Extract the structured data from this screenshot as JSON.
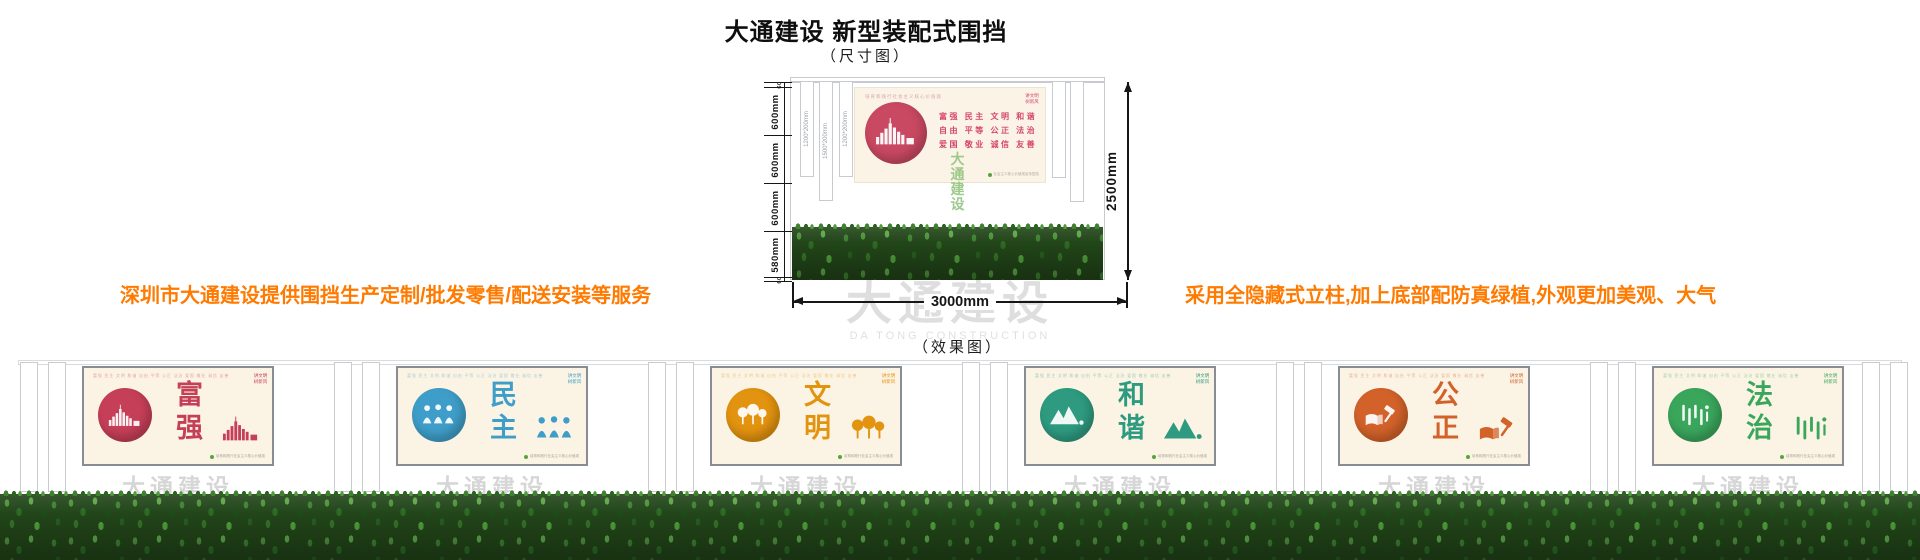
{
  "page": {
    "title": "大通建设 新型装配式围挡",
    "dimension_caption": "（尺寸图）",
    "effect_caption": "（效果图）"
  },
  "notes": {
    "left": "深圳市大通建设提供围挡生产定制/批发零售/配送安装等服务",
    "right": "采用全隐藏式立柱,加上底部配防真绿植,外观更加美观、大气"
  },
  "diagram": {
    "total_width_label": "3000mm",
    "total_height_label": "2500mm",
    "height_segments": [
      {
        "label": "60",
        "mm": 60
      },
      {
        "label": "600mm",
        "mm": 600
      },
      {
        "label": "600mm",
        "mm": 600
      },
      {
        "label": "600mm",
        "mm": 600
      },
      {
        "label": "580mm",
        "mm": 580
      },
      {
        "label": "60",
        "mm": 60
      }
    ],
    "post_size_labels": [
      "1200*200mm",
      "1500*200mm",
      "1200*200mm"
    ],
    "poster": {
      "header": "培育和践行社会主义核心价值观",
      "corner": "讲文明 树新风",
      "value_rows": [
        "富强 民主 文明 和谐",
        "自由 平等 公正 法治",
        "爱国 敬业 诚信 友善"
      ],
      "footnote": "社会主义核心价值观宣传围挡"
    },
    "green_watermark": [
      "大通",
      "建设"
    ],
    "watermark": {
      "cn": "大通建设",
      "en": "DA TONG CONSTRUCTION"
    }
  },
  "effect": {
    "panel_common": {
      "header": "富强 民主 文明 和谐 自由 平等 公正 法治 爱国 敬业 诚信 友善",
      "corner": "讲文明 树新风",
      "footnote": "培育和践行社会主义核心价值观",
      "watermark_cn": "大通建设",
      "watermark_en": "DA TONG CONSTRUCTION"
    },
    "panels": [
      {
        "word": "富强",
        "color": "#c63f58",
        "icon": "city-bars-icon"
      },
      {
        "word": "民主",
        "color": "#3f9ec9",
        "icon": "people-icon"
      },
      {
        "word": "文明",
        "color": "#e2930f",
        "icon": "trees-icon"
      },
      {
        "word": "和谐",
        "color": "#2e9b80",
        "icon": "mountains-icon"
      },
      {
        "word": "公正",
        "color": "#d2622a",
        "icon": "book-gavel-icon"
      },
      {
        "word": "法治",
        "color": "#3aa65c",
        "icon": "script-icon"
      }
    ]
  },
  "colors": {
    "accent_orange": "#ff7a00",
    "panel_cream": "#fbf4e5",
    "hedge_green": "#2f6b27",
    "line_black": "#161616",
    "watermark_grey": "#d9d9d9"
  }
}
